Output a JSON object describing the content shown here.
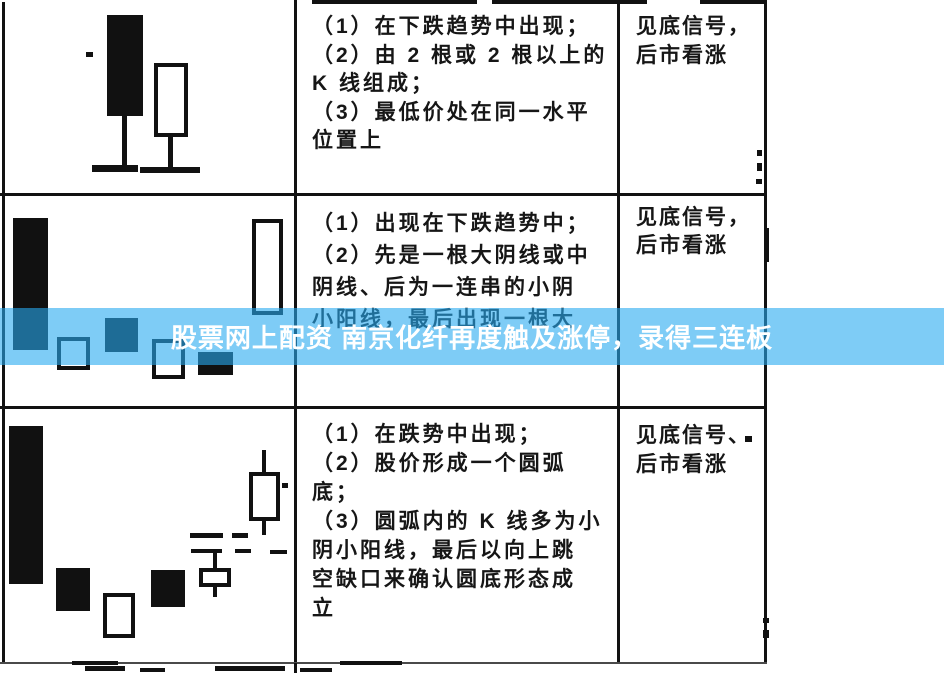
{
  "banner": {
    "text": "股票网上配资 南京化纤再度触及涨停，录得三连板",
    "color": "rgba(40,170,240,0.6)",
    "text_color": "#ffffff"
  },
  "table": {
    "rows": [
      {
        "pattern_lines": [
          "（1）在下跌趋势中出现；",
          "（2）由 2 根或 2 根以上的",
          "K 线组成；",
          "（3）最低价处在同一水平",
          "位置上"
        ],
        "signal_lines": [
          "见底信号，",
          "后市看涨"
        ]
      },
      {
        "pattern_lines": [
          "（1）出现在下跌趋势中；",
          "（2）先是一根大阴线或中",
          "阴线、后为一连串的小阴",
          "小阳线，最后出现一根大"
        ],
        "signal_lines": [
          "见底信号，",
          "后市看涨"
        ]
      },
      {
        "pattern_lines": [
          "（1）在跌势中出现；",
          "（2）股价形成一个圆弧",
          "底；",
          "（3）圆弧内的 K 线多为小",
          "阴小阳线，最后以向上跳",
          "空缺口来确认圆底形态成",
          "立"
        ],
        "signal_lines": [
          "见底信号、",
          "后市看涨"
        ]
      }
    ]
  },
  "artwork": {
    "ink": "#111111",
    "elements": [
      {
        "n": "table-border-top",
        "t": "rule",
        "x": 312,
        "y": 0,
        "w": 165,
        "h": 4
      },
      {
        "n": "table-border-top",
        "t": "rule",
        "x": 492,
        "y": 0,
        "w": 155,
        "h": 4
      },
      {
        "n": "table-border-top",
        "t": "rule",
        "x": 700,
        "y": 0,
        "w": 66,
        "h": 4
      },
      {
        "n": "table-border-left",
        "t": "rule",
        "x": 2,
        "y": 2,
        "w": 3,
        "h": 661
      },
      {
        "n": "table-border-col1",
        "t": "rule",
        "x": 294,
        "y": 0,
        "w": 3,
        "h": 663
      },
      {
        "n": "table-border-col2",
        "t": "rule",
        "x": 617,
        "y": 0,
        "w": 3,
        "h": 663
      },
      {
        "n": "table-border-right",
        "t": "rule",
        "x": 764,
        "y": 0,
        "w": 3,
        "h": 663
      },
      {
        "n": "table-row-divider",
        "t": "rule",
        "x": 0,
        "y": 193,
        "w": 767,
        "h": 3
      },
      {
        "n": "table-row-divider",
        "t": "rule",
        "x": 0,
        "y": 406,
        "w": 767,
        "h": 3
      },
      {
        "n": "table-border-bottom",
        "t": "rule",
        "x": 0,
        "y": 662,
        "w": 767,
        "h": 2,
        "c": "#4a4a4a"
      },
      {
        "n": "table-border-tail",
        "t": "rule",
        "x": 294,
        "y": 663,
        "w": 3,
        "h": 10
      },
      {
        "n": "candle-filled",
        "t": "fill",
        "x": 107,
        "y": 15,
        "w": 36,
        "h": 101
      },
      {
        "n": "candle-wick",
        "t": "fill",
        "x": 122,
        "y": 116,
        "w": 5,
        "h": 51
      },
      {
        "n": "candle-base-line",
        "t": "fill",
        "x": 92,
        "y": 165,
        "w": 46,
        "h": 7
      },
      {
        "n": "candle-hollow",
        "t": "hollow",
        "x": 154,
        "y": 63,
        "w": 34,
        "h": 74
      },
      {
        "n": "candle-wick",
        "t": "fill",
        "x": 168,
        "y": 136,
        "w": 5,
        "h": 33
      },
      {
        "n": "candle-base-line",
        "t": "fill",
        "x": 140,
        "y": 167,
        "w": 60,
        "h": 6
      },
      {
        "n": "candle-filled",
        "t": "fill",
        "x": 13,
        "y": 218,
        "w": 35,
        "h": 132
      },
      {
        "n": "candle-hollow",
        "t": "hollow",
        "x": 57,
        "y": 337,
        "w": 33,
        "h": 33
      },
      {
        "n": "candle-filled",
        "t": "fill",
        "x": 105,
        "y": 318,
        "w": 33,
        "h": 34
      },
      {
        "n": "candle-hollow",
        "t": "hollow",
        "x": 152,
        "y": 339,
        "w": 33,
        "h": 40
      },
      {
        "n": "candle-filled",
        "t": "fill",
        "x": 198,
        "y": 352,
        "w": 35,
        "h": 23
      },
      {
        "n": "candle-hollow",
        "t": "hollow",
        "x": 252,
        "y": 219,
        "w": 31,
        "h": 96
      },
      {
        "n": "candle-filled",
        "t": "fill",
        "x": 9,
        "y": 426,
        "w": 34,
        "h": 158
      },
      {
        "n": "candle-filled",
        "t": "fill",
        "x": 56,
        "y": 568,
        "w": 34,
        "h": 43
      },
      {
        "n": "candle-hollow",
        "t": "hollow",
        "x": 103,
        "y": 593,
        "w": 32,
        "h": 45
      },
      {
        "n": "candle-filled",
        "t": "fill",
        "x": 151,
        "y": 570,
        "w": 34,
        "h": 37
      },
      {
        "n": "candle-hollow",
        "t": "hollow",
        "x": 199,
        "y": 568,
        "w": 32,
        "h": 19
      },
      {
        "n": "candle-wick",
        "t": "fill",
        "x": 213,
        "y": 553,
        "w": 4,
        "h": 15
      },
      {
        "n": "candle-wick",
        "t": "fill",
        "x": 213,
        "y": 587,
        "w": 4,
        "h": 10
      },
      {
        "n": "gap-dash",
        "t": "fill",
        "x": 190,
        "y": 533,
        "w": 33,
        "h": 5
      },
      {
        "n": "gap-dash",
        "t": "fill",
        "x": 232,
        "y": 533,
        "w": 16,
        "h": 5
      },
      {
        "n": "gap-dash",
        "t": "fill",
        "x": 191,
        "y": 549,
        "w": 31,
        "h": 4
      },
      {
        "n": "gap-dash",
        "t": "fill",
        "x": 235,
        "y": 549,
        "w": 16,
        "h": 4
      },
      {
        "n": "gap-dash",
        "t": "fill",
        "x": 270,
        "y": 550,
        "w": 17,
        "h": 4
      },
      {
        "n": "candle-hollow",
        "t": "hollow",
        "x": 249,
        "y": 472,
        "w": 31,
        "h": 49
      },
      {
        "n": "candle-wick",
        "t": "fill",
        "x": 262,
        "y": 450,
        "w": 4,
        "h": 22
      },
      {
        "n": "candle-wick",
        "t": "fill",
        "x": 262,
        "y": 521,
        "w": 4,
        "h": 14
      },
      {
        "n": "noise-speck",
        "t": "fill",
        "x": 86,
        "y": 52,
        "w": 7,
        "h": 5
      },
      {
        "n": "noise-speck",
        "t": "fill",
        "x": 757,
        "y": 150,
        "w": 5,
        "h": 6
      },
      {
        "n": "noise-speck",
        "t": "fill",
        "x": 757,
        "y": 163,
        "w": 5,
        "h": 8
      },
      {
        "n": "noise-speck",
        "t": "fill",
        "x": 756,
        "y": 179,
        "w": 6,
        "h": 5
      },
      {
        "n": "noise-speck",
        "t": "fill",
        "x": 764,
        "y": 228,
        "w": 5,
        "h": 34
      },
      {
        "n": "noise-speck",
        "t": "fill",
        "x": 745,
        "y": 436,
        "w": 7,
        "h": 6
      },
      {
        "n": "noise-speck",
        "t": "fill",
        "x": 282,
        "y": 483,
        "w": 6,
        "h": 5
      },
      {
        "n": "noise-speck",
        "t": "fill",
        "x": 763,
        "y": 618,
        "w": 6,
        "h": 5
      },
      {
        "n": "noise-speck",
        "t": "fill",
        "x": 763,
        "y": 630,
        "w": 6,
        "h": 8
      },
      {
        "n": "noise-speck",
        "t": "fill",
        "x": 72,
        "y": 661,
        "w": 46,
        "h": 4
      },
      {
        "n": "noise-speck",
        "t": "fill",
        "x": 340,
        "y": 661,
        "w": 62,
        "h": 4
      },
      {
        "n": "noise-speck",
        "t": "fill",
        "x": 85,
        "y": 666,
        "w": 40,
        "h": 5
      },
      {
        "n": "noise-speck",
        "t": "fill",
        "x": 140,
        "y": 668,
        "w": 25,
        "h": 4
      },
      {
        "n": "noise-speck",
        "t": "fill",
        "x": 215,
        "y": 666,
        "w": 70,
        "h": 5
      },
      {
        "n": "noise-speck",
        "t": "fill",
        "x": 300,
        "y": 668,
        "w": 32,
        "h": 4
      }
    ]
  }
}
